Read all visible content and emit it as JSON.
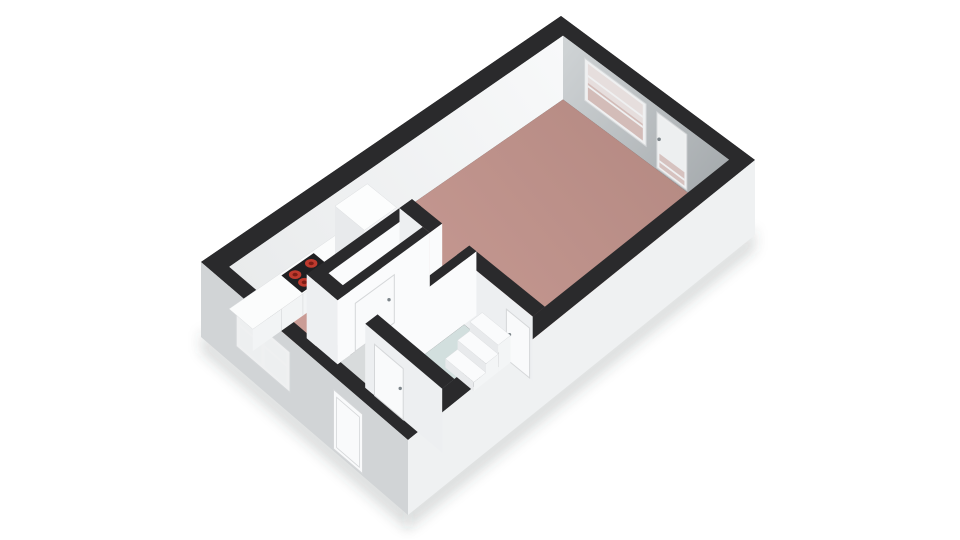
{
  "page": {
    "background": "#ffffff",
    "description": "3d-floorplan-studio-apartment"
  },
  "floorplan": {
    "projection": {
      "corners": {
        "w": [
          201,
          262
        ],
        "n": [
          561,
          16
        ],
        "e": [
          755,
          160
        ],
        "s": [
          408,
          440
        ]
      },
      "inner": {
        "p0": 0.035,
        "p1": 0.965,
        "q0": 0.075,
        "q1": 0.93
      },
      "interior_wall_height_px": 64,
      "exterior_wall_drop_px": 75
    },
    "palette": {
      "wall_top": "#2a2a2c",
      "wall_nw_far": "#f8f9fa",
      "wall_nw_near": "#e9ebec",
      "wall_ne_light": "#d0d4d6",
      "wall_ne_dark": "#a7acaf",
      "wall_ext_sw": "#d1d4d6",
      "wall_ext_se": "#eff1f2",
      "wall_face_shade": "#edeff1",
      "wall_face_bright": "#fafbfc",
      "floor_living_near": "#cd9f98",
      "floor_living_far": "#b58a83",
      "floor_bath": "#d2dfde",
      "floor_hall": "#d8dbdc",
      "floor_closet": "#d4d6d8",
      "counter_top": "#fbfcfc",
      "counter_front": "#f2f4f5",
      "counter_side": "#e8eaec",
      "counter_edge": "#dcdee0",
      "cab_top": "#fcfdfd",
      "cab_front": "#f4f5f7",
      "cab_side": "#e8eaec",
      "step_top": "#fafbfc",
      "step_front": "#f3f5f6",
      "step_side": "#e8eaec",
      "cooktop": "#202022",
      "burner": "#bf3a2e",
      "burner_core": "#7c1d15",
      "frame": "#eff0f1",
      "frame_line": "#d4d7d9",
      "glass": "#e6dedd",
      "glass_door": "#edeff0",
      "glass_tint": "#caa9a4",
      "door_leaf": "#f9fafb",
      "door_line": "#d5d7d9",
      "handle": "#7d858a",
      "shadow": "rgba(60,64,68,0.18)"
    },
    "floors": {
      "living": {
        "name": "living-room-and-kitchen-floor",
        "outline": [
          [
            0.035,
            0.075
          ],
          [
            0.965,
            0.075
          ],
          [
            0.965,
            0.93
          ],
          [
            0.435,
            0.93
          ],
          [
            0.435,
            0.27
          ],
          [
            0.035,
            0.27
          ]
        ]
      },
      "hall": {
        "name": "hallway-floor",
        "outline": [
          [
            0.035,
            0.27
          ],
          [
            0.14,
            0.27
          ],
          [
            0.14,
            0.42
          ],
          [
            0.435,
            0.42
          ],
          [
            0.435,
            0.555
          ],
          [
            0.14,
            0.555
          ],
          [
            0.14,
            0.93
          ],
          [
            0.035,
            0.93
          ]
        ]
      },
      "bathroom": {
        "name": "bathroom-floor",
        "outline": [
          [
            0.175,
            0.59
          ],
          [
            0.4,
            0.59
          ],
          [
            0.4,
            0.93
          ],
          [
            0.175,
            0.93
          ]
        ]
      },
      "closet": {
        "name": "closet-floor",
        "outline": [
          [
            0.175,
            0.315
          ],
          [
            0.4,
            0.315
          ],
          [
            0.4,
            0.385
          ],
          [
            0.175,
            0.385
          ]
        ]
      }
    },
    "interior_walls": [
      {
        "name": "closet-nw-wall",
        "p": [
          0.14,
          0.435
        ],
        "q": [
          0.27,
          0.315
        ],
        "faces": [
          "minus_p",
          "plus_q"
        ]
      },
      {
        "name": "closet-ne-wall",
        "p": [
          0.4,
          0.435
        ],
        "q": [
          0.27,
          0.42
        ],
        "faces": [
          "minus_p",
          "plus_q"
        ]
      },
      {
        "name": "bathroom-ne-wall",
        "p": [
          0.4,
          0.435
        ],
        "q": [
          0.555,
          0.93
        ],
        "faces": [
          "minus_p"
        ],
        "door": {
          "name": "bathroom-living-door",
          "face": "minus_p",
          "at": 0.4,
          "span": [
            0.8,
            0.915
          ],
          "h": [
            0,
            0.78
          ],
          "handle": [
            0.815,
            0.42
          ]
        },
        "steps": [
          {
            "p": [
              0.365,
              0.4
            ],
            "q": [
              0.68,
              0.82
            ],
            "h": 0.42
          },
          {
            "p": [
              0.33,
              0.365
            ],
            "q": [
              0.68,
              0.82
            ],
            "h": 0.28
          },
          {
            "p": [
              0.295,
              0.33
            ],
            "q": [
              0.68,
              0.82
            ],
            "h": 0.14
          }
        ]
      },
      {
        "name": "bathroom-nw-wall",
        "p": [
          0.14,
          0.435
        ],
        "q": [
          0.555,
          0.59
        ],
        "faces": [
          "minus_p",
          "plus_q"
        ]
      },
      {
        "name": "closet-se-wall",
        "p": [
          0.14,
          0.4
        ],
        "q": [
          0.385,
          0.42
        ],
        "faces": [
          "minus_p",
          "plus_q"
        ],
        "door": {
          "name": "closet-door",
          "face": "plus_q",
          "at": 0.42,
          "span": [
            0.19,
            0.3
          ],
          "h": [
            0,
            0.75
          ],
          "handle": [
            0.285,
            0.42
          ]
        }
      },
      {
        "name": "hall-closet-wall",
        "p": [
          0.14,
          0.175
        ],
        "q": [
          0.27,
          0.42
        ],
        "faces": [
          "minus_p",
          "plus_q"
        ]
      },
      {
        "name": "hall-bathroom-wall",
        "p": [
          0.14,
          0.175
        ],
        "q": [
          0.555,
          0.93
        ],
        "faces": [
          "minus_p"
        ],
        "door": {
          "name": "bathroom-hall-door",
          "face": "minus_p",
          "at": 0.14,
          "span": [
            0.6,
            0.74
          ],
          "h": [
            0,
            0.8
          ],
          "handle": [
            0.725,
            0.45
          ]
        }
      }
    ],
    "kitchen": {
      "counter": {
        "p": [
          0.035,
          0.33
        ],
        "q": [
          0.075,
          0.19
        ],
        "h": 0.34,
        "seams": [
          0.115,
          0.175,
          0.265
        ]
      },
      "cooktop": {
        "p": [
          0.175,
          0.265
        ],
        "q": [
          0.085,
          0.185
        ],
        "h": 0.345
      },
      "burners": [
        [
          0.1975,
          0.1125
        ],
        [
          0.2425,
          0.1125
        ],
        [
          0.1975,
          0.1575
        ],
        [
          0.2425,
          0.1575
        ]
      ],
      "tall_cabinet": {
        "p": [
          0.33,
          0.42
        ],
        "q": [
          0.075,
          0.22
        ],
        "h": 0.8
      }
    },
    "ne_wall": {
      "window": {
        "u": [
          0.13,
          0.5
        ],
        "h": [
          0.24,
          0.9
        ],
        "hbars": [
          0.5,
          0.66
        ],
        "tint_top": 0.55
      },
      "balcony_door": {
        "u": [
          0.565,
          0.745
        ],
        "h": [
          0.03,
          0.9
        ],
        "hbars": [
          0.16
        ],
        "tint_top": 0.28,
        "handle": [
          0.578,
          0.5
        ]
      }
    },
    "sw_wall": {
      "window": {
        "u": [
          0.17,
          0.43
        ],
        "h": [
          0.28,
          0.82
        ],
        "vbars": [
          0.3
        ],
        "hbars": [
          0.6
        ]
      },
      "entrance_door": {
        "u": [
          0.64,
          0.78
        ],
        "h": [
          0.03,
          0.82
        ]
      }
    }
  }
}
